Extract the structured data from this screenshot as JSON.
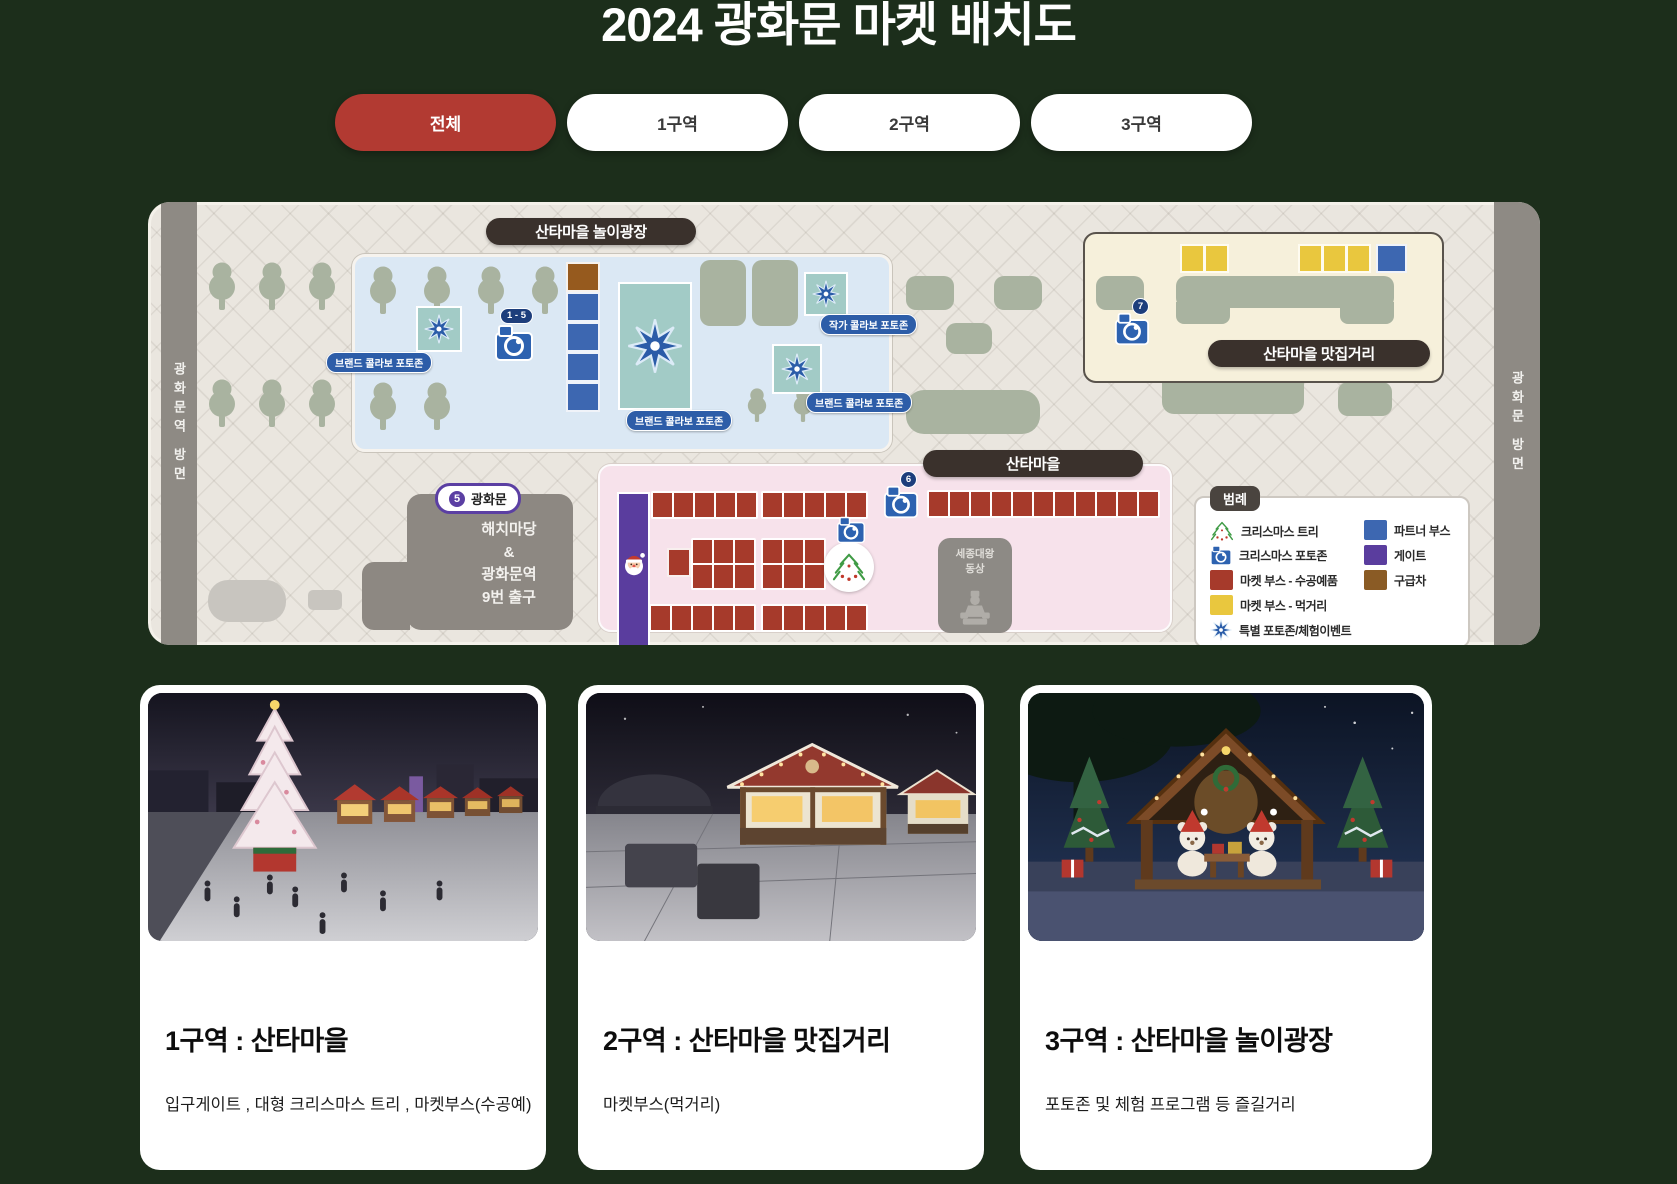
{
  "title": "2024 광화문 마켓 배치도",
  "tabs": [
    {
      "label": "전체",
      "active": true
    },
    {
      "label": "1구역",
      "active": false
    },
    {
      "label": "2구역",
      "active": false
    },
    {
      "label": "3구역",
      "active": false
    }
  ],
  "map": {
    "left_road": "광화문역 방면",
    "right_road": "광화문 방면",
    "zone3_banner": "산타마을 놀이광장",
    "zone2_banner": "산타마을 맛집거리",
    "zone1_banner": "산타마을",
    "photozone_labels": {
      "brand1": "브랜드 콜라보 포토존",
      "brand2": "브랜드 콜라보 포토존",
      "brand3": "브랜드 콜라보 포토존",
      "artist": "작가 콜라보 포토존"
    },
    "camera_badges": {
      "range": "1 - 5",
      "six": "6",
      "seven": "7"
    },
    "station": {
      "number": "5",
      "name": "광화문"
    },
    "haechi_lines": [
      "해치마당",
      "&",
      "광화문역",
      "9번 출구"
    ],
    "sejong_lines": [
      "세종대왕",
      "동상"
    ],
    "legend": {
      "title": "범례",
      "left": [
        {
          "icon": "christmas-tree-icon",
          "label": "크리스마스 트리"
        },
        {
          "icon": "camera-icon",
          "label": "크리스마스 포토존"
        },
        {
          "swatch": "#a63a2b",
          "label": "마켓 부스 - 수공예품"
        },
        {
          "swatch": "#e9c73e",
          "label": "마켓 부스 - 먹거리"
        },
        {
          "icon": "star-icon",
          "label": "특별 포토존/체험이벤트"
        }
      ],
      "right": [
        {
          "swatch": "#3d67b1",
          "label": "파트너 부스"
        },
        {
          "swatch": "#5a3d9e",
          "label": "게이트"
        },
        {
          "swatch": "#8a5b25",
          "label": "구급차"
        }
      ]
    }
  },
  "cards": [
    {
      "title": "1구역 : 산타마을",
      "desc": "입구게이트 , 대형 크리스마스 트리 , 마켓부스(수공예)"
    },
    {
      "title": "2구역 : 산타마을 맛집거리",
      "desc": "마켓부스(먹거리)"
    },
    {
      "title": "3구역 : 산타마을 놀이광장",
      "desc": "포토존 및 체험 프로그램 등 즐길거리"
    }
  ],
  "colors": {
    "page_bg": "#1c2e1b",
    "active_tab": "#b23a32",
    "map_bg": "#eae6df",
    "zone3_bg": "#dbe8f4",
    "zone2_bg": "#f6f0db",
    "zone1_bg": "#f7e2eb",
    "banner_bg": "#3a312c",
    "booth_craft": "#a63a2b",
    "booth_food": "#e9c73e",
    "partner_booth": "#3d67b1",
    "gate": "#5a3d9e",
    "first_aid": "#8a5b25",
    "photozone_teal": "#a2cbc6",
    "label_pill_blue": "#2d5da8",
    "road_gray": "#8e8a84"
  }
}
